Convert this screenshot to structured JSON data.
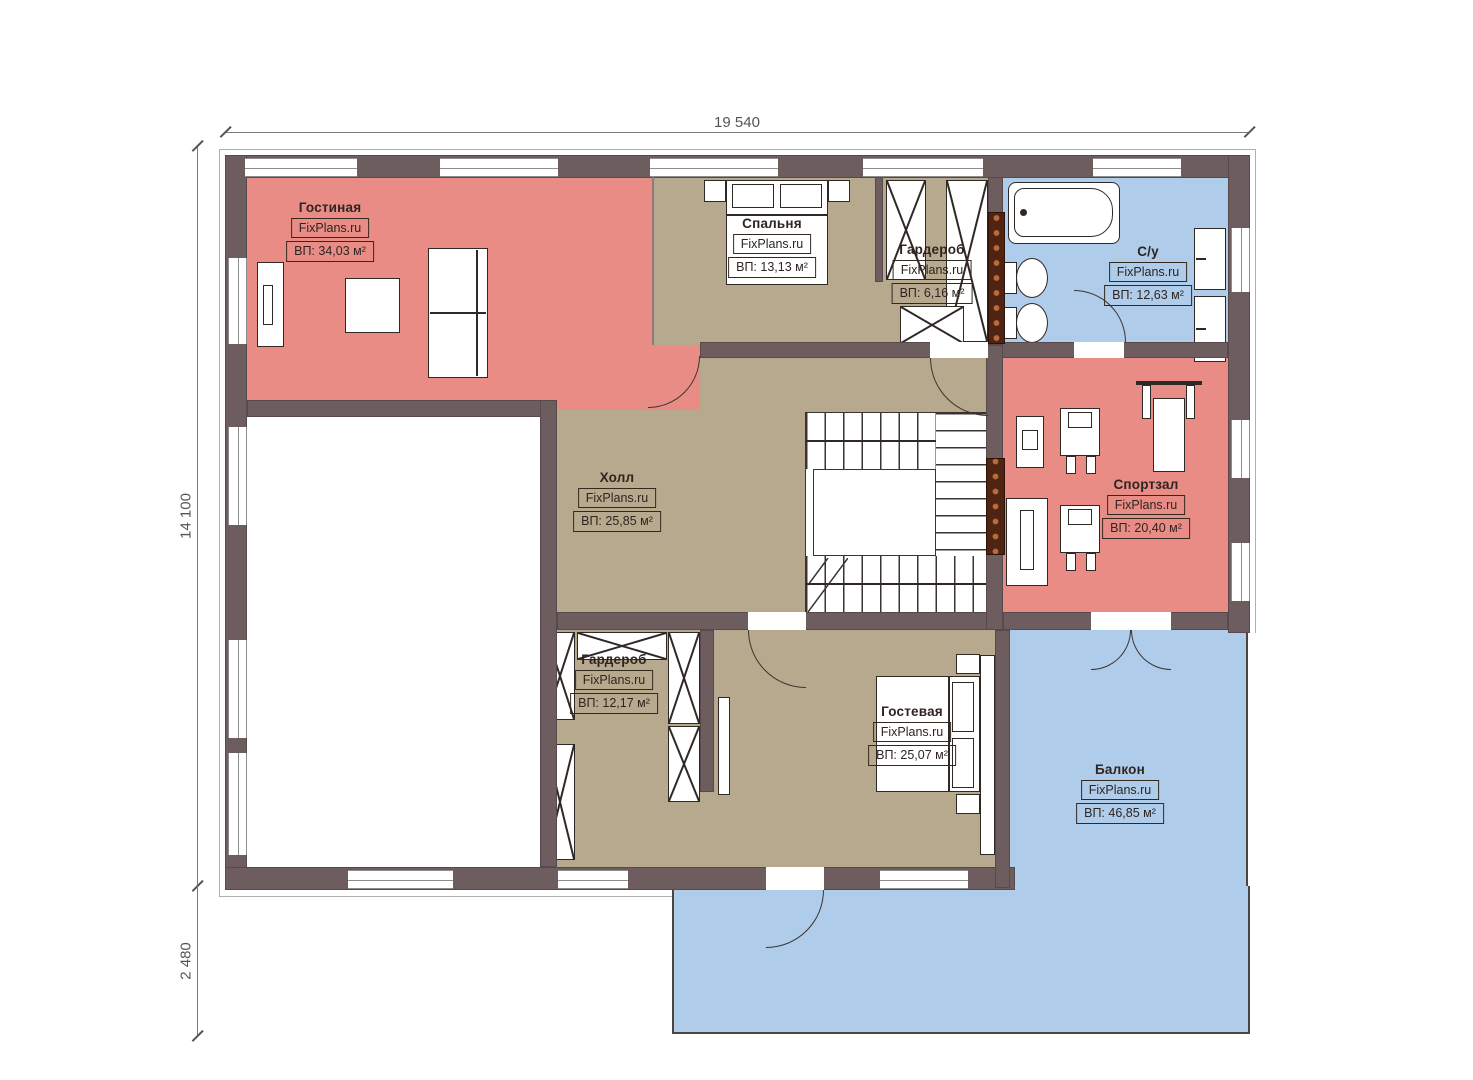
{
  "brand": {
    "watermark": "FixPlans.ru"
  },
  "dimensions": {
    "top": "19 540",
    "left": "14 100",
    "left_lower": "2 480"
  },
  "rooms": [
    {
      "name": "Гостиная",
      "watermark": "FixPlans.ru",
      "area": "ВП: 34,03 м²"
    },
    {
      "name": "Спальня",
      "watermark": "FixPlans.ru",
      "area": "ВП: 13,13 м²"
    },
    {
      "name": "Гардероб",
      "watermark": "FixPlans.ru",
      "area": "ВП: 6,16 м²"
    },
    {
      "name": "С/у",
      "watermark": "FixPlans.ru",
      "area": "ВП: 12,63 м²"
    },
    {
      "name": "Холл",
      "watermark": "FixPlans.ru",
      "area": "ВП: 25,85 м²"
    },
    {
      "name": "Спортзал",
      "watermark": "FixPlans.ru",
      "area": "ВП: 20,40 м²"
    },
    {
      "name": "Гардероб",
      "watermark": "FixPlans.ru",
      "area": "ВП: 12,17 м²"
    },
    {
      "name": "Гостевая",
      "watermark": "FixPlans.ru",
      "area": "ВП: 25,07 м²"
    },
    {
      "name": "Балкон",
      "watermark": "FixPlans.ru",
      "area": "ВП: 46,85 м²"
    }
  ],
  "colors": {
    "wall": "#6e5d5f",
    "room_pink": "#e98c86",
    "room_beige": "#b6a98d",
    "room_blue": "#afccea",
    "radiator": "#4f2413",
    "line": "#3a3330",
    "dimension": "#555555",
    "label_text": "#2e2521"
  }
}
